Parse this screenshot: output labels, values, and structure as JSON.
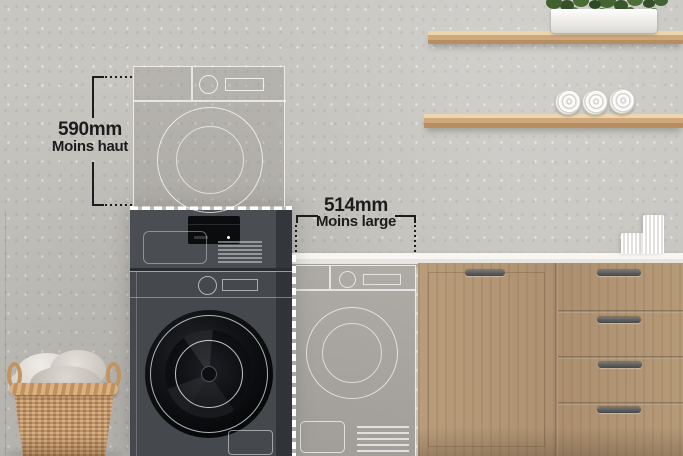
{
  "scene": {
    "title": "Stacked washer-dryer space saving comparison",
    "language": "fr"
  },
  "annotations": {
    "height_saving": {
      "value": "590mm",
      "caption": "Moins haut"
    },
    "width_saving": {
      "value": "514mm",
      "caption": "Moins large"
    }
  },
  "colors": {
    "wall": "#c8c6c1",
    "countertop": "#f3f2ee",
    "cabinet_wood": "#b39876",
    "shelf_wood": "#cfa87c",
    "machine_body": "#45484c",
    "machine_door": "#0b0d10",
    "ghost_outline": "#fafaf8",
    "annotation_text": "#1c1c1c",
    "basket_wicker": "#c89b6a",
    "plant_green": "#41612f"
  },
  "objects": [
    "ghost-dryer-outline",
    "ghost-washer-outline",
    "stacked-washer-dryer",
    "wall-shelf-top",
    "wall-shelf-bottom",
    "plant-in-planter",
    "rolled-towels",
    "countertop",
    "white-cups",
    "wood-cabinet",
    "laundry-basket"
  ]
}
